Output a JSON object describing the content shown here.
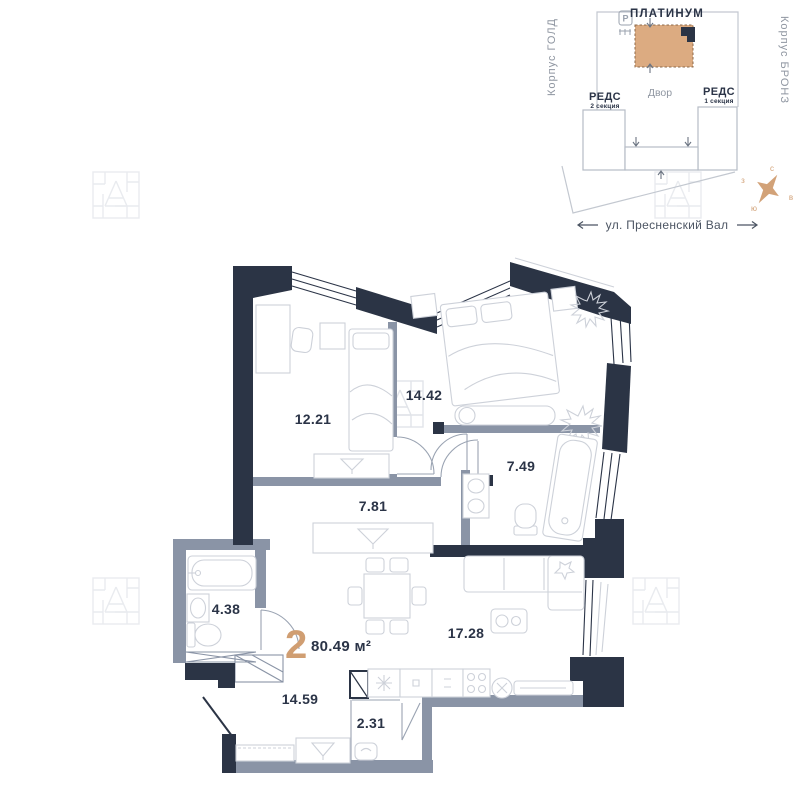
{
  "site_plan": {
    "title": "ПЛАТИНУМ",
    "courtyard_label": "Двор",
    "left_section": {
      "name": "РЕДС",
      "subtitle": "2 секция"
    },
    "right_section": {
      "name": "РЕДС",
      "subtitle": "1 секция"
    },
    "left_building": "Корпус ГОЛД",
    "right_building": "Корпус БРОНЗ",
    "street_label": "ул. Пресненский Вал",
    "parking_icon_label": "P"
  },
  "compass": {
    "north": "с",
    "west": "з",
    "east": "в",
    "south": "ю"
  },
  "apartment": {
    "rooms_count": "2",
    "total_area": "80.49 м²",
    "rooms": [
      {
        "name": "bedroom-1",
        "area": "12.21"
      },
      {
        "name": "bedroom-2",
        "area": "14.42"
      },
      {
        "name": "bathroom-main",
        "area": "7.49"
      },
      {
        "name": "hallway",
        "area": "7.81"
      },
      {
        "name": "bathroom-small",
        "area": "4.38"
      },
      {
        "name": "living-kitchen",
        "area": "17.28"
      },
      {
        "name": "corridor",
        "area": "14.59"
      },
      {
        "name": "wardrobe",
        "area": "2.31"
      }
    ]
  },
  "colors": {
    "wall_dark": "#2b3445",
    "wall_light": "#8a94a6",
    "accent_tan": "#d09e72",
    "building_fill": "#dcab81",
    "furniture_line": "#cdd1d9",
    "watermark": "#e9ebef"
  }
}
